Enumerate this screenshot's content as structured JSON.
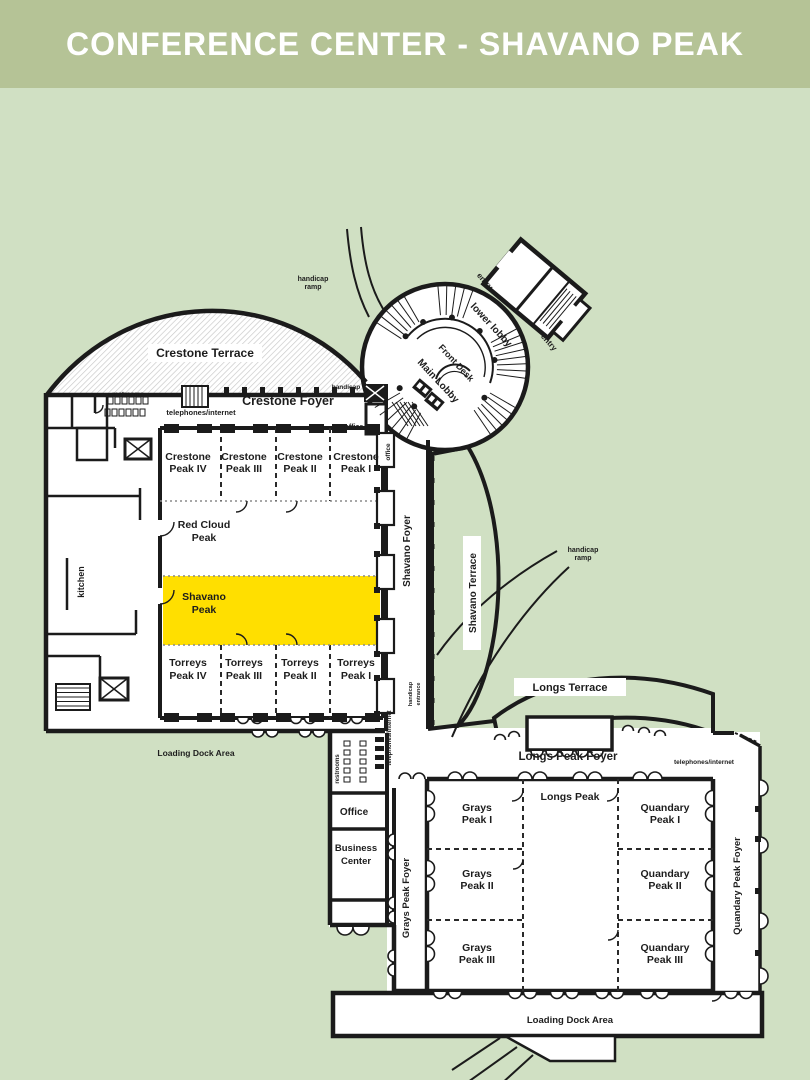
{
  "header": {
    "title": "CONFERENCE CENTER - SHAVANO PEAK"
  },
  "colors": {
    "header_bg": "#b5c396",
    "page_bg": "#d0e0c3",
    "walls": "#1b1b1b",
    "highlight": "#ffdf00",
    "highlight_text": "#d9c233"
  },
  "highlighted_room": "Shavano Peak",
  "plan": {
    "lobby": {
      "lower": "lower lobby",
      "front_desk": "Front Desk",
      "main": "Main Lobby",
      "entry_a": "entry",
      "entry_b": "entry",
      "handicap_ramp": [
        "handicap",
        "ramp"
      ]
    },
    "north": {
      "terrace": "Crestone Terrace",
      "foyer": "Crestone Foyer",
      "restrooms": "restrooms",
      "telephones": "telephones/internet",
      "handicap_entrance": [
        "handicap",
        "entrance"
      ],
      "office_small": "office",
      "office_side": "office",
      "kitchen": "kitchen",
      "loading_dock": "Loading Dock Area",
      "crestone": [
        [
          "Crestone",
          "Peak IV"
        ],
        [
          "Crestone",
          "Peak III"
        ],
        [
          "Crestone",
          "Peak II"
        ],
        [
          "Crestone",
          "Peak I"
        ]
      ],
      "red_cloud": [
        "Red Cloud",
        "Peak"
      ],
      "shavano": [
        "Shavano",
        "Peak"
      ],
      "torreys": [
        [
          "Torreys",
          "Peak IV"
        ],
        [
          "Torreys",
          "Peak III"
        ],
        [
          "Torreys",
          "Peak II"
        ],
        [
          "Torreys",
          "Peak I"
        ]
      ]
    },
    "wing": {
      "foyer": "Shavano Foyer",
      "terrace": "Shavano Terrace",
      "handicap_entrance": [
        "handicap",
        "entrance"
      ],
      "handicap_ramp": [
        "handicap",
        "ramp"
      ]
    },
    "connector": {
      "restrooms": "restrooms",
      "telephones": "telephones/internet",
      "office": "Office",
      "business": [
        "Business",
        "Center"
      ]
    },
    "south": {
      "terrace": "Longs Terrace",
      "foyer": "Longs Peak Foyer",
      "telephones": "telephones/internet",
      "longs": "Longs Peak",
      "grays": [
        [
          "Grays",
          "Peak I"
        ],
        [
          "Grays",
          "Peak II"
        ],
        [
          "Grays",
          "Peak III"
        ]
      ],
      "quandary": [
        [
          "Quandary",
          "Peak I"
        ],
        [
          "Quandary",
          "Peak II"
        ],
        [
          "Quandary",
          "Peak III"
        ]
      ],
      "grays_foyer": "Grays Peak Foyer",
      "quandary_foyer": "Quandary Peak Foyer",
      "loading_dock": "Loading Dock Area"
    }
  }
}
